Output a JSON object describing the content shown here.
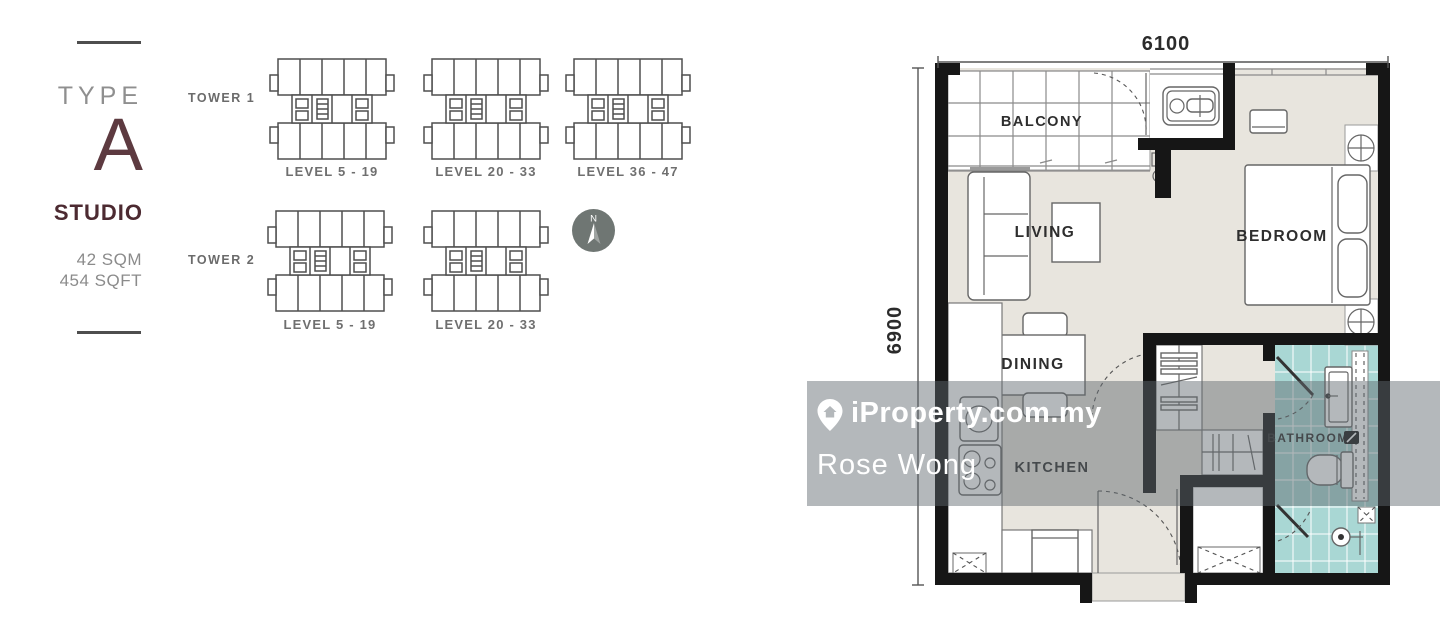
{
  "unit": {
    "type_label": "TYPE",
    "type_letter": "A",
    "category": "STUDIO",
    "area_sqm": "42 SQM",
    "area_sqft": "454 SQFT"
  },
  "keyplans": {
    "tower1": {
      "label": "TOWER 1",
      "levels": [
        "LEVEL 5 - 19",
        "LEVEL 20 - 33",
        "LEVEL 36 - 47"
      ]
    },
    "tower2": {
      "label": "TOWER 2",
      "levels": [
        "LEVEL 5 - 19",
        "LEVEL 20 - 33"
      ]
    }
  },
  "compass": {
    "north_label": "N"
  },
  "floorplan": {
    "dimensions": {
      "width": "6100",
      "height": "6900"
    },
    "rooms": {
      "balcony": "BALCONY",
      "living": "LIVING",
      "bedroom": "BEDROOM",
      "dining": "DINING",
      "kitchen": "KITCHEN",
      "bathroom": "BATHROOM"
    }
  },
  "watermark": {
    "brand": "iProperty.com.my",
    "agent": "Rose Wong"
  },
  "colors": {
    "accent_maroon": "#4c2a31",
    "floor_beige": "#e8e5de",
    "bathroom_teal": "#a9d7d4",
    "wall_black": "#161616",
    "keyplan_highlight_gray": "#d6d6d6",
    "compass_gray": "#6f7673",
    "watermark_overlay": "rgba(96,105,110,0.47)"
  }
}
